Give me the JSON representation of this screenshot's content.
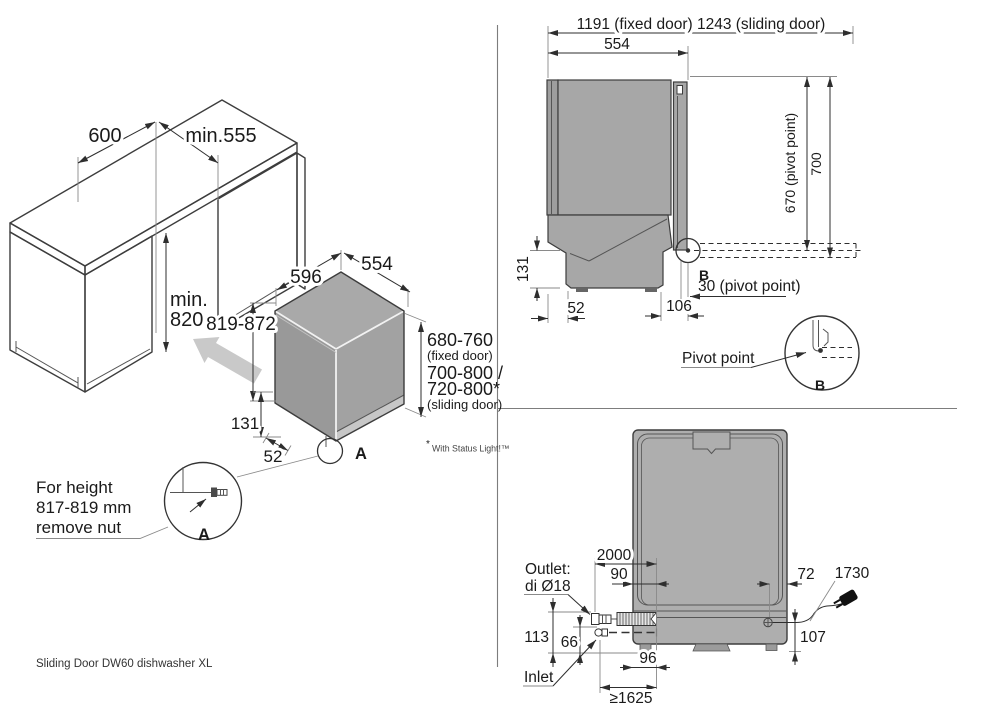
{
  "page": {
    "footer": "Sliding Door DW60 dishwasher XL",
    "status_note_star": "*",
    "status_note": "With Status Light!™"
  },
  "iso_view": {
    "counter_width": "600",
    "opening_width": "min.555",
    "opening_height_1": "min.",
    "opening_height_2": "820",
    "dw_height_adjust": "819-872",
    "dw_width": "596",
    "dw_depth": "554",
    "door_fixed": "680-760",
    "door_fixed_note": "(fixed door)",
    "door_sliding_1": "700-800 /",
    "door_sliding_2": "720-800*",
    "door_sliding_note": "(sliding door)",
    "base_height": "131",
    "base_depth": "52",
    "detail_mark": "A",
    "detail_label": "A",
    "note_line1": "For height",
    "note_line2": "817-819 mm",
    "note_line3": "remove nut"
  },
  "side_view": {
    "total_depth": "1191 (fixed door) 1243 (sliding door)",
    "body_depth": "554",
    "pivot_height": "670 (pivot point)",
    "total_height": "700",
    "base_height": "131",
    "back_offset": "52",
    "pivot_offset": "106",
    "pivot_note": "30 (pivot point)",
    "detail_mark": "B",
    "pivot_detail_label": "Pivot point",
    "detail_label": "B"
  },
  "plan_view": {
    "drain_hose_length": "2000",
    "drain_offset": "90",
    "cord_offset": "72",
    "cord_length": "1730",
    "outlet_line1": "Outlet:",
    "outlet_line2": "di Ø18",
    "outlet_height": "113",
    "inlet_height": "66",
    "inlet_label": "Inlet",
    "drain_edge_offset": "96",
    "inlet_hose_length": "≥1625",
    "cord_height": "107"
  }
}
